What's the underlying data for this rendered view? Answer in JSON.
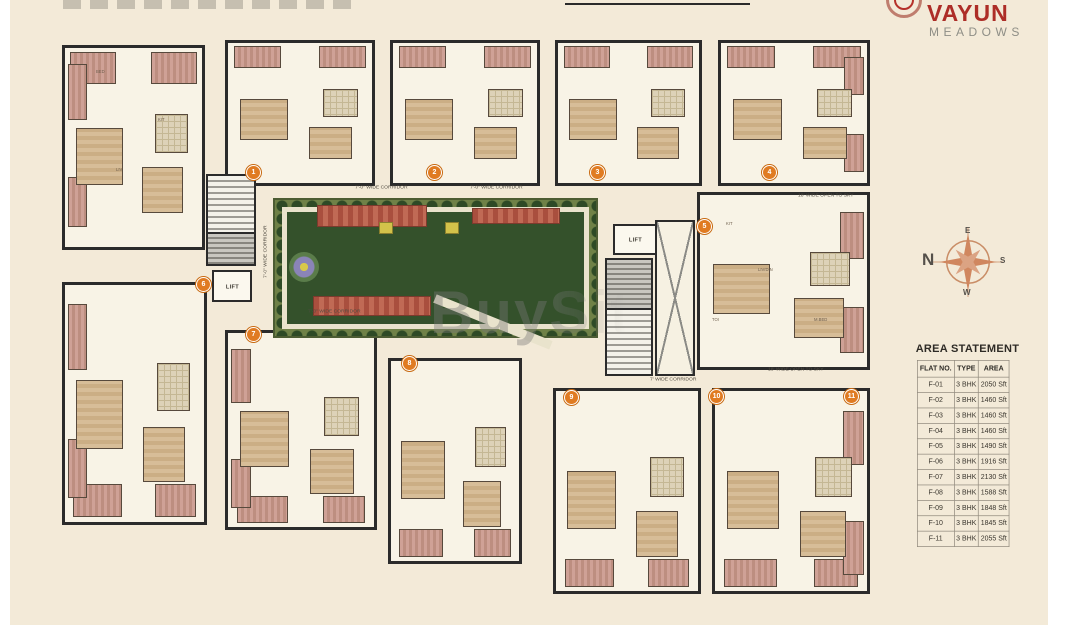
{
  "brand": {
    "name": "VAYUN",
    "tagline": "MEADOWS"
  },
  "watermark": "BuySit",
  "compass": {
    "north": "N",
    "east": "E",
    "south": "S",
    "west": "W"
  },
  "labels": {
    "corridor": "7'-0\" WIDE CORRIDOR",
    "corridor_short": "7' WIDE CORRIDOR",
    "open_to_sky": "18' WIDE OPEN TO SKY",
    "lift": "LIFT"
  },
  "rooms": {
    "master_bed": "M.BED",
    "bed": "BED",
    "kitchen": "KIT",
    "living": "LIV/DIN",
    "living_short": "LIV",
    "toilet": "TOI",
    "balcony": "BALCONY"
  },
  "units": {
    "badges": [
      "1",
      "2",
      "3",
      "4",
      "5",
      "6",
      "7",
      "8",
      "9",
      "10",
      "11"
    ]
  },
  "area_statement": {
    "title": "AREA STATEMENT",
    "columns": [
      "FLAT NO.",
      "TYPE",
      "AREA"
    ],
    "rows": [
      [
        "F-01",
        "3 BHK",
        "2050 Sft"
      ],
      [
        "F-02",
        "3 BHK",
        "1460 Sft"
      ],
      [
        "F-03",
        "3 BHK",
        "1460 Sft"
      ],
      [
        "F-04",
        "3 BHK",
        "1460 Sft"
      ],
      [
        "F-05",
        "3 BHK",
        "1490 Sft"
      ],
      [
        "F-06",
        "3 BHK",
        "1916 Sft"
      ],
      [
        "F-07",
        "3 BHK",
        "2130 Sft"
      ],
      [
        "F-08",
        "3 BHK",
        "1588 Sft"
      ],
      [
        "F-09",
        "3 BHK",
        "1848 Sft"
      ],
      [
        "F-10",
        "3 BHK",
        "1845 Sft"
      ],
      [
        "F-11",
        "3 BHK",
        "2055 Sft"
      ]
    ]
  },
  "colors": {
    "logo_red": "#ad2d27",
    "badge_orange": "#e07b22",
    "garden_green": "#34512b",
    "canvas_beige": "#f3ead8"
  }
}
